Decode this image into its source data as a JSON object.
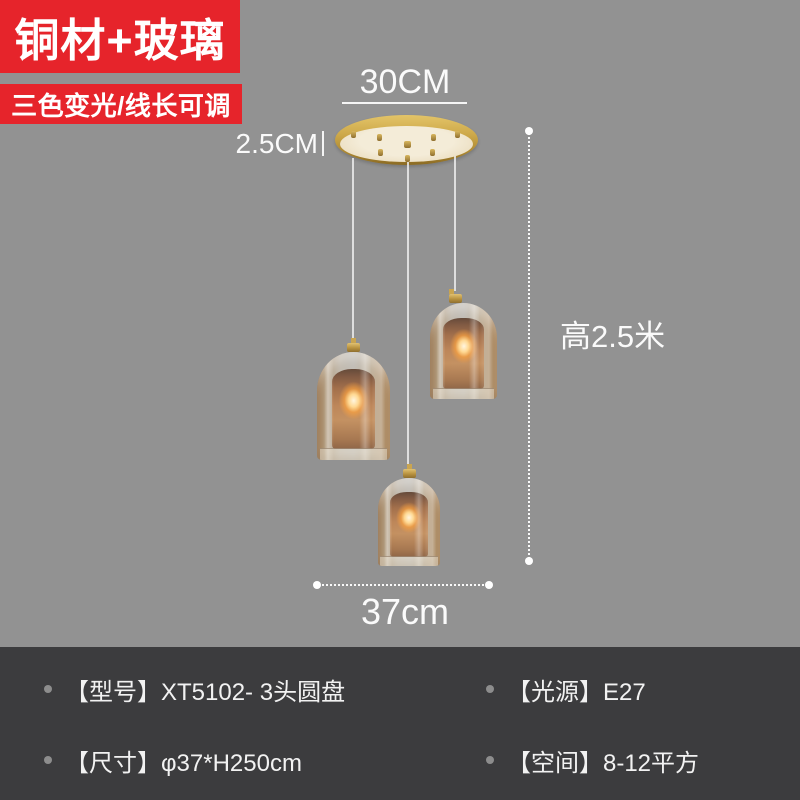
{
  "badges": {
    "material": "铜材+玻璃",
    "feature": "三色变光/线长可调"
  },
  "annotations": {
    "disc_diameter": "30CM",
    "disc_thickness": "2.5CM",
    "drop_height": "高2.5米",
    "spread_width": "37cm"
  },
  "specs": {
    "model": "【型号】XT5102- 3头圆盘",
    "light_source": "【光源】E27",
    "size": "【尺寸】φ37*H250cm",
    "space": "【空间】8-12平方"
  },
  "colors": {
    "badge_red": "#e6242b",
    "background_gray": "#929292",
    "spec_bar_dark": "#3c3c3e",
    "brass_gold": "#cda849",
    "glass_amber": "#c48e5c",
    "annotation_white": "#fafafa"
  }
}
